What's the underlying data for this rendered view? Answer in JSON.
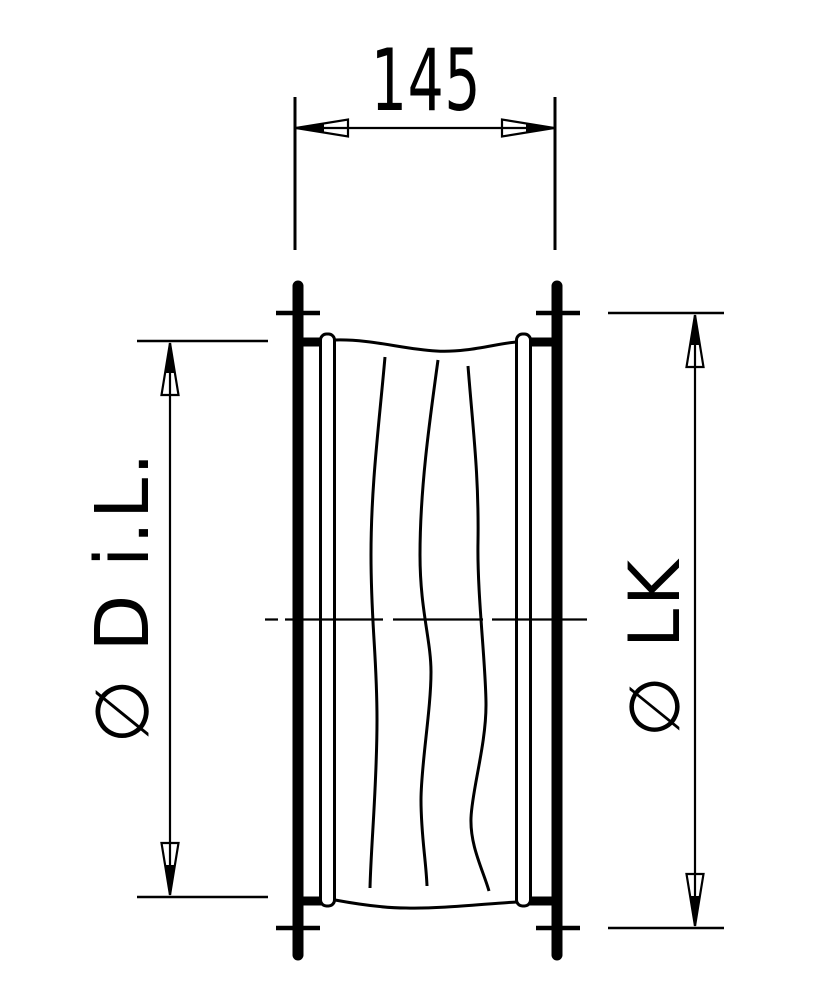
{
  "drawing": {
    "type": "technical-drawing",
    "subject": "flexible-duct-connector-section-view",
    "background_color": "#ffffff",
    "line_color": "#000000",
    "dimensions": {
      "length": {
        "label": "145",
        "orientation": "horizontal",
        "position": "top"
      },
      "inner_diameter": {
        "label": "∅ D i.L.",
        "orientation": "vertical",
        "position": "left"
      },
      "bolt_circle": {
        "label": "∅ LK",
        "orientation": "vertical",
        "position": "right"
      }
    }
  }
}
